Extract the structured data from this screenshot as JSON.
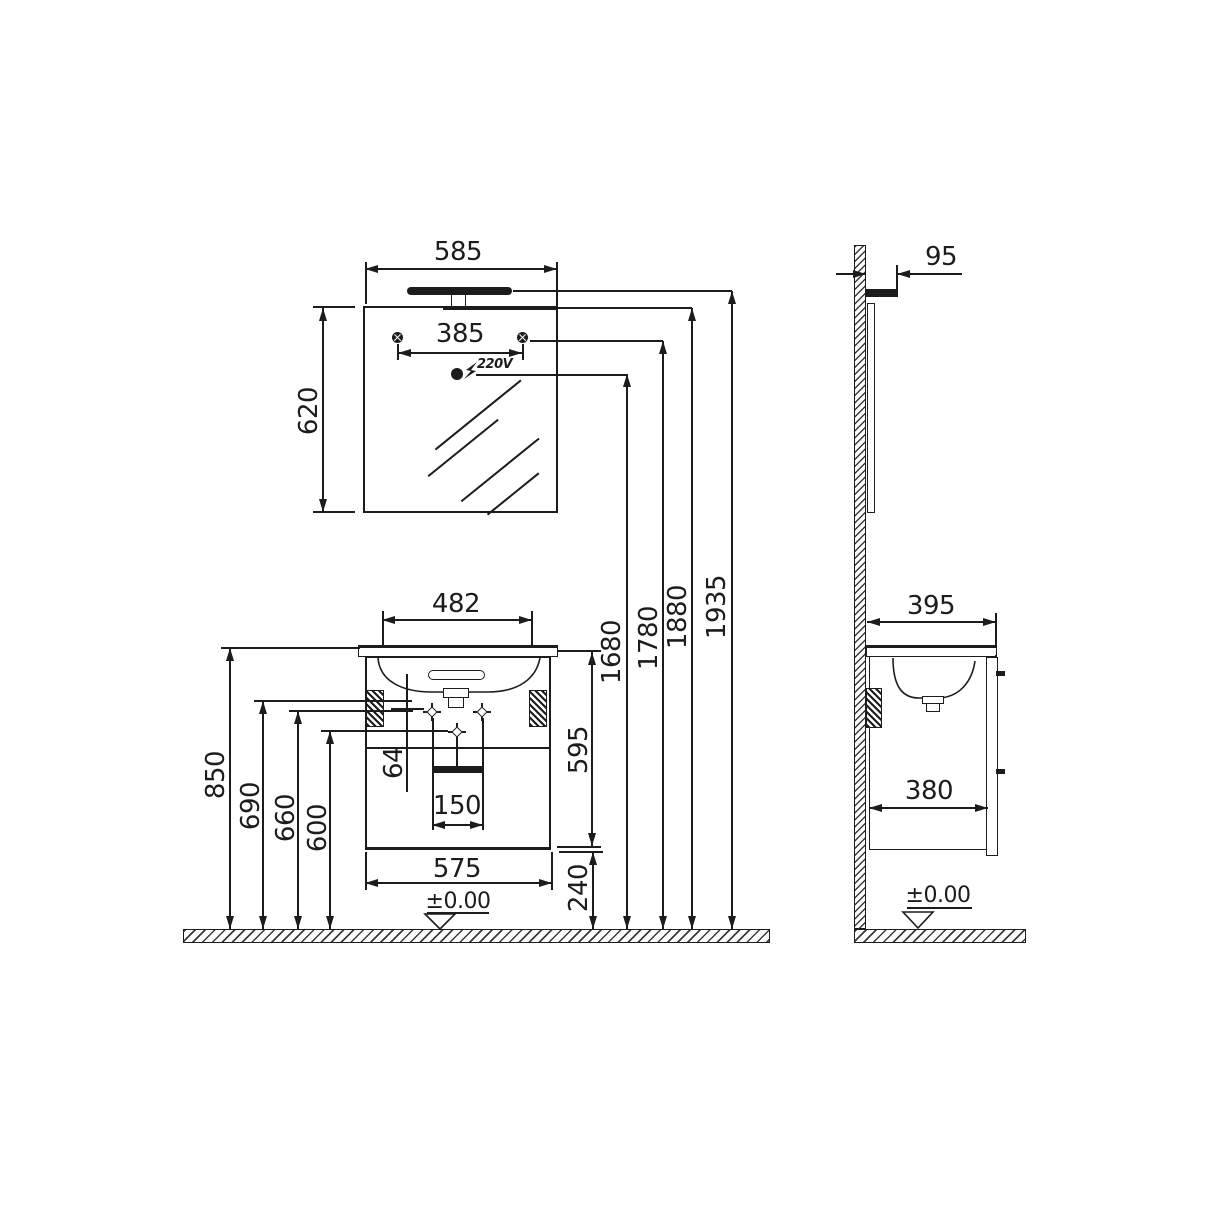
{
  "d": {
    "front": {
      "mirror_width": "585",
      "mirror_height": "620",
      "hole_spacing": "385",
      "outlet": "220V",
      "basin_width": "482",
      "countertop_height": "850",
      "bracket_height_1": "690",
      "bracket_height_2": "660",
      "mount_height": "600",
      "mount_offset": "64",
      "handle_width": "150",
      "cabinet_width": "575",
      "cabinet_height": "595",
      "floor_clearance": "240",
      "outlet_height": "1680",
      "holes_height": "1780",
      "mirror_top_height": "1880",
      "light_top_height": "1935",
      "floor_datum": "±0.00"
    },
    "side": {
      "light_depth": "95",
      "countertop_depth": "395",
      "cabinet_depth": "380",
      "floor_datum": "±0.00"
    },
    "colors": {
      "line": "#1c1c1c",
      "background": "#ffffff"
    }
  }
}
